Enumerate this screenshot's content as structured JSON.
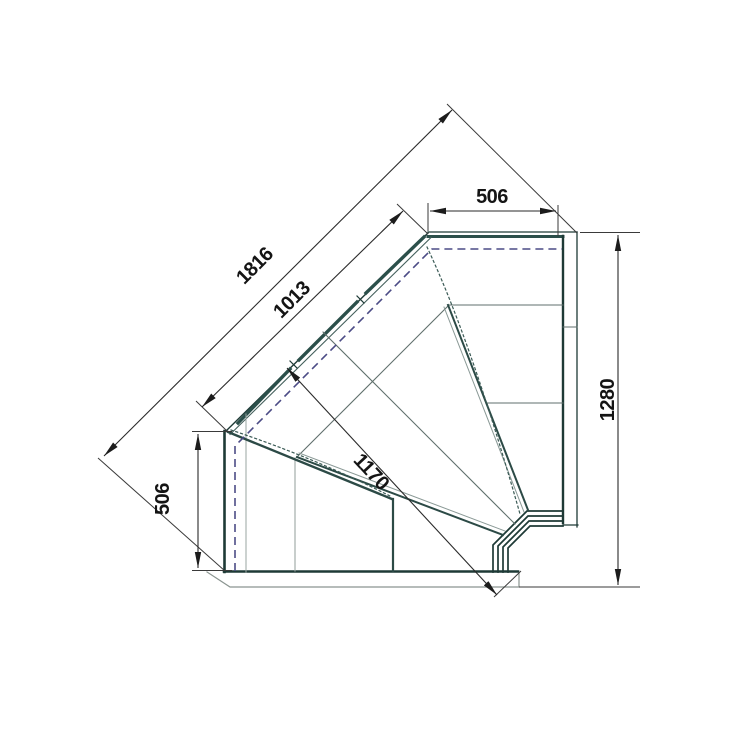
{
  "drawing": {
    "type": "plan-view technical drawing",
    "subject": "90-degree internal corner serve-over display counter",
    "dimensions_mm": {
      "connection_end_top": "506",
      "overall_front_diagonal": "1816",
      "glass_front_diagonal": "1013",
      "corner_depth_diagonal": "1170",
      "connection_end_left": "506",
      "back_side_length": "1280"
    },
    "line_colors": {
      "outline": "#1e3a36",
      "glass_highlight": "#2b4f4a",
      "internal": "#5f6f6c",
      "light_internal": "#9aa5a2",
      "plinth": "#8a9490",
      "dashed_line": "#4c4c86",
      "dimension": "#2a2a2a"
    }
  }
}
